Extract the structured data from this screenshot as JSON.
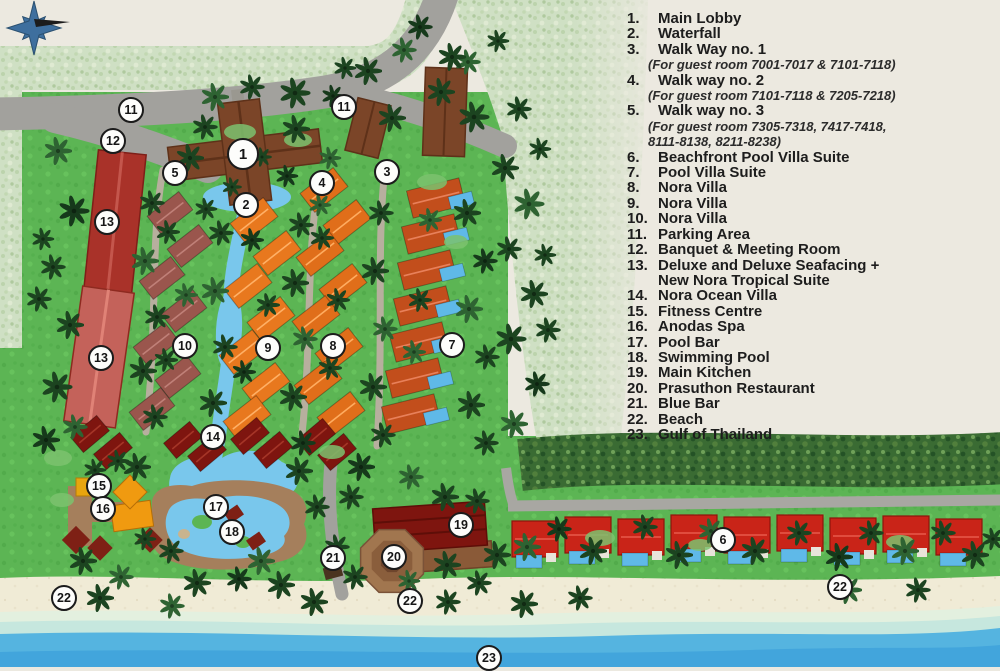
{
  "legend": {
    "items": [
      {
        "num": "1.",
        "lines": [
          "Main Lobby"
        ]
      },
      {
        "num": "2.",
        "lines": [
          "Waterfall"
        ]
      },
      {
        "num": "3.",
        "lines": [
          "Walk Way no. 1"
        ],
        "notes": [
          "(For guest room 7001-7017 & 7101-7118)"
        ]
      },
      {
        "num": "4.",
        "lines": [
          "Walk way no. 2"
        ],
        "notes": [
          "(For guest room 7101-7118 & 7205-7218)"
        ]
      },
      {
        "num": "5.",
        "lines": [
          "Walk way no. 3"
        ],
        "notes": [
          "(For guest room 7305-7318, 7417-7418,",
          "8111-8138, 8211-8238)"
        ]
      },
      {
        "num": "6.",
        "lines": [
          "Beachfront Pool Villa Suite"
        ]
      },
      {
        "num": "7.",
        "lines": [
          "Pool Villa Suite"
        ]
      },
      {
        "num": "8.",
        "lines": [
          "Nora Villa"
        ]
      },
      {
        "num": "9.",
        "lines": [
          "Nora Villa"
        ]
      },
      {
        "num": "10.",
        "lines": [
          "Nora Villa"
        ]
      },
      {
        "num": "11.",
        "lines": [
          "Parking Area"
        ]
      },
      {
        "num": "12.",
        "lines": [
          "Banquet & Meeting Room"
        ]
      },
      {
        "num": "13.",
        "lines": [
          "Deluxe and Deluxe Seafacing +",
          "New Nora Tropical Suite"
        ]
      },
      {
        "num": "14.",
        "lines": [
          "Nora Ocean Villa"
        ]
      },
      {
        "num": "15.",
        "lines": [
          "Fitness Centre"
        ]
      },
      {
        "num": "16.",
        "lines": [
          "Anodas Spa"
        ]
      },
      {
        "num": "17.",
        "lines": [
          "Pool Bar"
        ]
      },
      {
        "num": "18.",
        "lines": [
          "Swimming Pool"
        ]
      },
      {
        "num": "19.",
        "lines": [
          "Main Kitchen"
        ]
      },
      {
        "num": "20.",
        "lines": [
          "Prasuthon Restaurant"
        ]
      },
      {
        "num": "21.",
        "lines": [
          "Blue Bar"
        ]
      },
      {
        "num": "22.",
        "lines": [
          "Beach"
        ]
      },
      {
        "num": "23.",
        "lines": [
          "Gulf of Thailand"
        ]
      }
    ]
  },
  "map": {
    "markers": [
      {
        "n": "1",
        "x": 243,
        "y": 154,
        "d": 32
      },
      {
        "n": "2",
        "x": 246,
        "y": 205
      },
      {
        "n": "3",
        "x": 387,
        "y": 172
      },
      {
        "n": "4",
        "x": 322,
        "y": 183
      },
      {
        "n": "5",
        "x": 175,
        "y": 173
      },
      {
        "n": "6",
        "x": 723,
        "y": 540
      },
      {
        "n": "7",
        "x": 452,
        "y": 345
      },
      {
        "n": "8",
        "x": 333,
        "y": 346
      },
      {
        "n": "9",
        "x": 268,
        "y": 348
      },
      {
        "n": "10",
        "x": 185,
        "y": 346
      },
      {
        "n": "11",
        "x": 131,
        "y": 110
      },
      {
        "n": "11",
        "x": 344,
        "y": 107
      },
      {
        "n": "12",
        "x": 113,
        "y": 141
      },
      {
        "n": "13",
        "x": 107,
        "y": 222
      },
      {
        "n": "13",
        "x": 101,
        "y": 358
      },
      {
        "n": "14",
        "x": 213,
        "y": 437
      },
      {
        "n": "15",
        "x": 99,
        "y": 486
      },
      {
        "n": "16",
        "x": 103,
        "y": 509
      },
      {
        "n": "17",
        "x": 216,
        "y": 507
      },
      {
        "n": "18",
        "x": 232,
        "y": 532
      },
      {
        "n": "19",
        "x": 461,
        "y": 525
      },
      {
        "n": "20",
        "x": 394,
        "y": 557
      },
      {
        "n": "21",
        "x": 333,
        "y": 558
      },
      {
        "n": "22",
        "x": 64,
        "y": 598
      },
      {
        "n": "22",
        "x": 410,
        "y": 601
      },
      {
        "n": "22",
        "x": 840,
        "y": 587
      },
      {
        "n": "23",
        "x": 489,
        "y": 658
      }
    ],
    "colors": {
      "bg": "#ECE9E0",
      "lawn": "#5CB554",
      "sand": "#F0EBD6",
      "sea_mint": "#E3F0DF",
      "sea_aqua": "#C6E7DE",
      "sea_blue": "#55B4E0",
      "sea_deep": "#42A5DC",
      "water": "#79C7EC",
      "road": "#A2A19D",
      "path": "#B7AF9E",
      "hedge_dark": "#3A6B33",
      "hedge_light": "#CFE0C4",
      "tree": "#1C4420",
      "deck": "#A57F5C",
      "pool_blue": "#5FB9E8",
      "lobby": "#7B4528",
      "deluxe": "#A93229",
      "deluxe2": "#C4625A",
      "mauve": "#9A564D",
      "orange": "#E8781E",
      "orange2": "#E06E1A",
      "rust": "#C24E1C",
      "beach_red": "#C92418",
      "dark_red": "#7E150F",
      "spa_orange": "#F09A10",
      "marker_bg": "#FDFDFB",
      "marker_border": "#1B1B1B",
      "text": "#1D1D1D"
    }
  }
}
